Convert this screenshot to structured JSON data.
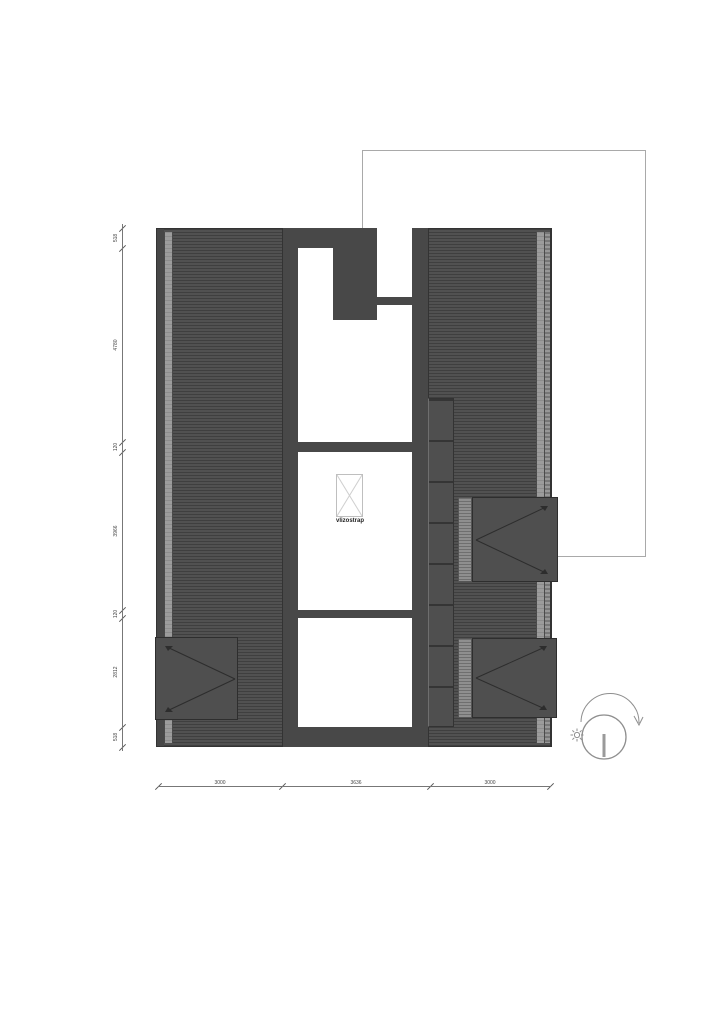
{
  "drawing": {
    "kind": "attic roof plan",
    "hatch_label": "vlizostrap"
  },
  "dimensions": {
    "left_chain": [
      "518",
      "4780",
      "120",
      "3966",
      "120",
      "2812",
      "518"
    ],
    "bottom_chain": [
      "3000",
      "3636",
      "3000"
    ]
  },
  "colors": {
    "roof_base": "#515151",
    "roof_hatch_line": "#3f3f3f",
    "wall": "#484848",
    "eave_strip": "#9c9c9c",
    "property_line": "#a9a9a9",
    "dimension_line": "#777777",
    "dimension_text": "#444444",
    "symbol_stroke": "#8f8f8f"
  },
  "icons": {
    "sun": "sun-icon",
    "sun_path": "sun-path-arc-icon",
    "loft_hatch": "loft-hatch-cross-icon",
    "dormer_arrows": "slope-direction-arrows-icon"
  }
}
